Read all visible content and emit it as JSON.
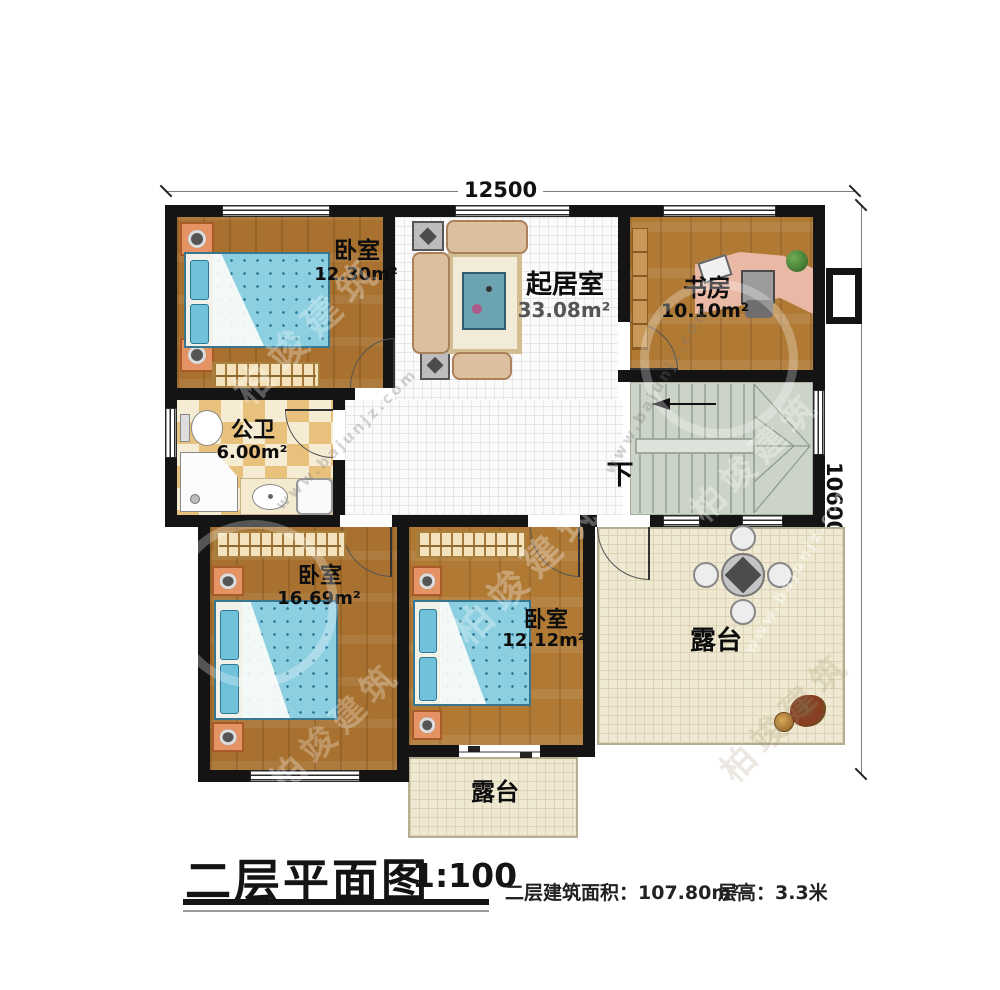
{
  "dimensions": {
    "width_top": "12500",
    "height_right": "10600"
  },
  "rooms": {
    "bedroom_top_left": {
      "name": "卧室",
      "area": "12.30m²"
    },
    "living_room": {
      "name": "起居室",
      "area": "33.08m²"
    },
    "study": {
      "name": "书房",
      "area": "10.10m²"
    },
    "bathroom": {
      "name": "公卫",
      "area": "6.00m²"
    },
    "bedroom_bottom_left": {
      "name": "卧室",
      "area": "16.69m²"
    },
    "bedroom_bottom_middle": {
      "name": "卧室",
      "area": "12.12m²"
    },
    "terrace_right": {
      "name": "露台"
    },
    "terrace_bottom": {
      "name": "露台"
    }
  },
  "stairs": {
    "direction_label": "下"
  },
  "title": {
    "main": "二层平面图",
    "scale": "1:100"
  },
  "footer": {
    "area_label": "二层建筑面积：",
    "area_value": "107.80m²",
    "floor_height_label": "层高：",
    "floor_height_value": "3.3米"
  },
  "watermark": {
    "brand": "柏竣建筑",
    "site": "www.bajunjz.com"
  }
}
